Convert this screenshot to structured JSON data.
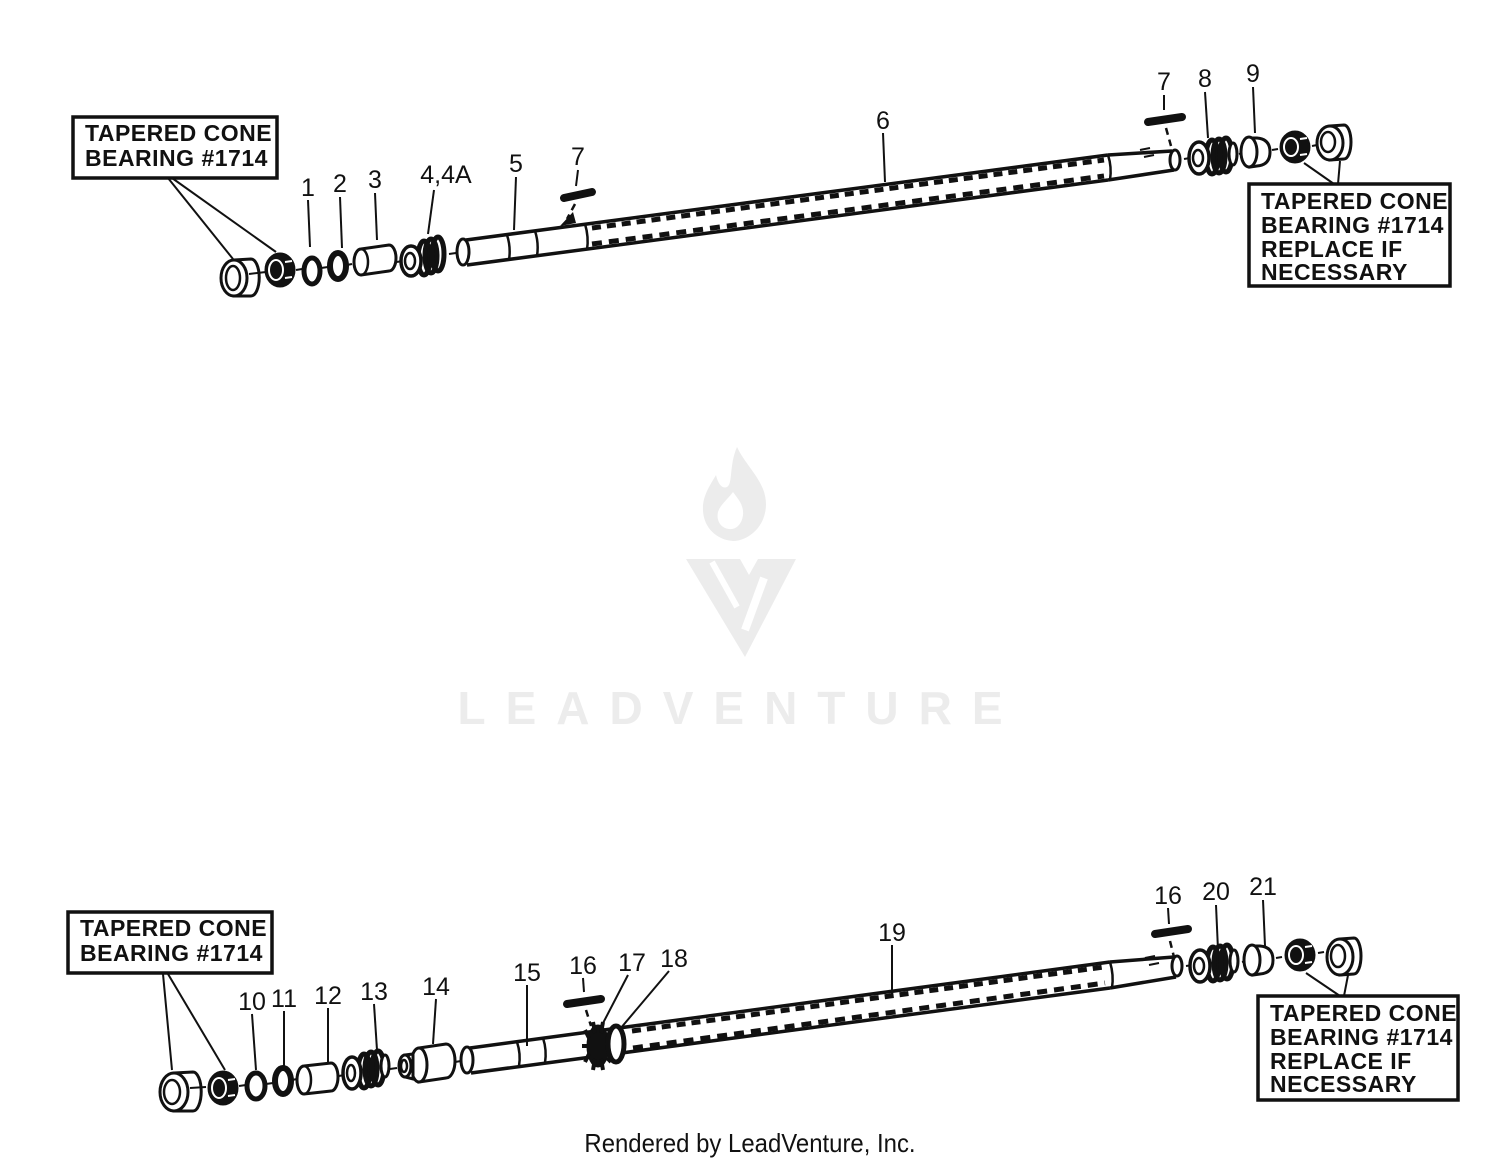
{
  "page": {
    "background": "#ffffff",
    "ink": "#111111"
  },
  "watermark": {
    "brand": "LEADVENTURE",
    "color": "#ececec",
    "logo": "leadventure-torch-icon"
  },
  "footer": {
    "credit": "Rendered by LeadVenture, Inc."
  },
  "diagram_top": {
    "callout_left": {
      "lines": [
        "TAPERED CONE",
        "BEARING #1714"
      ]
    },
    "callout_right": {
      "lines": [
        "TAPERED CONE",
        "BEARING #1714",
        "REPLACE IF",
        "NECESSARY"
      ]
    },
    "labels": [
      "1",
      "2",
      "3",
      "4,4A",
      "5",
      "7",
      "6",
      "7",
      "8",
      "9"
    ]
  },
  "diagram_bottom": {
    "callout_left": {
      "lines": [
        "TAPERED CONE",
        "BEARING #1714"
      ]
    },
    "callout_right": {
      "lines": [
        "TAPERED CONE",
        "BEARING #1714",
        "REPLACE IF",
        "NECESSARY"
      ]
    },
    "labels": [
      "10",
      "11",
      "12",
      "13",
      "14",
      "15",
      "16",
      "17",
      "18",
      "19",
      "16",
      "20",
      "21"
    ]
  }
}
